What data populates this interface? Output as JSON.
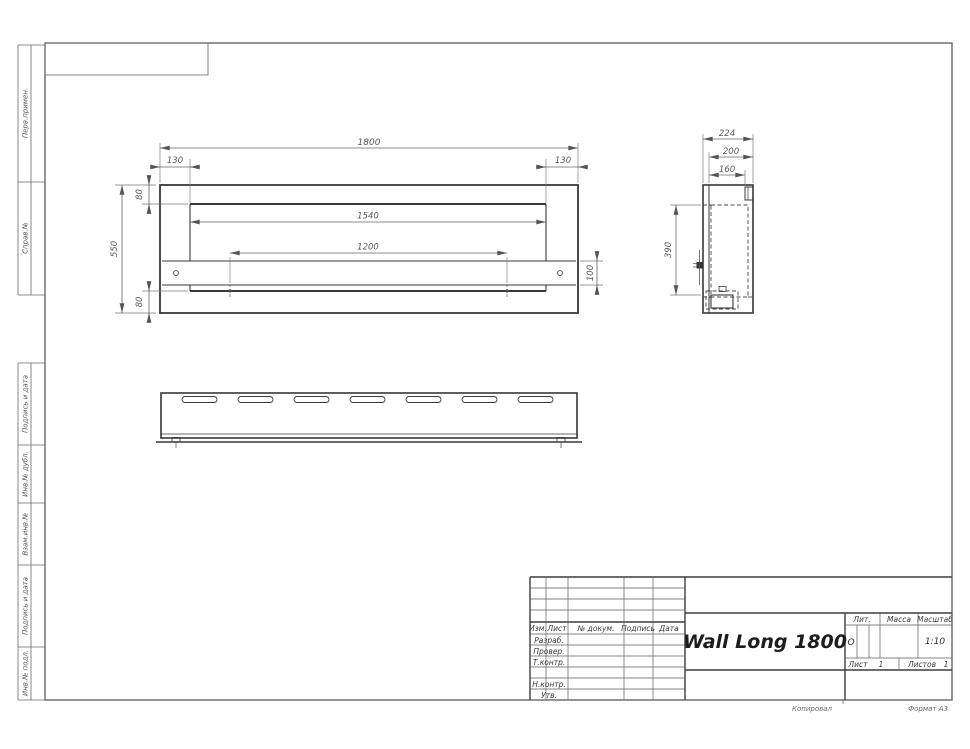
{
  "sidebar": {
    "items": [
      {
        "label": "Перв.примен."
      },
      {
        "label": "Справ.№"
      },
      {
        "label": "Подпись и дата"
      },
      {
        "label": "Инв.№ дубл."
      },
      {
        "label": "Взам.инв.№"
      },
      {
        "label": "Подпись и дата"
      },
      {
        "label": "Инв.№ подл."
      }
    ]
  },
  "front_view": {
    "dims": {
      "total_width": "1800",
      "left_offset": "130",
      "right_offset": "130",
      "top_border": "80",
      "opening_width": "1540",
      "mount_span": "1200",
      "bracket_height": "100",
      "total_height": "550",
      "bottom_border": "80"
    }
  },
  "side_view": {
    "dims": {
      "total_depth": "224",
      "body_depth": "200",
      "inner_depth": "160",
      "opening_height": "390"
    }
  },
  "title_block": {
    "title": "Wall Long 1800",
    "header_cols": {
      "izm": "Изм.",
      "list": "Лист",
      "doc": "№ докум.",
      "sign": "Подпись",
      "date": "Дата"
    },
    "row_labels": {
      "razrab": "Разраб.",
      "prover": "Провер.",
      "tkontr": "Т.контр.",
      "nkontr": "Н.контр.",
      "utv": "Утв."
    },
    "lit": {
      "label": "Лит.",
      "value": "О"
    },
    "massa": {
      "label": "Масса"
    },
    "masshtab": {
      "label": "Масштаб",
      "value": "1:10"
    },
    "sheet": {
      "list_label": "Лист",
      "list_value": "1",
      "listov_label": "Листов",
      "listov_value": "1"
    }
  },
  "footer": {
    "copied": "Копировал",
    "format": "Формат А3"
  }
}
